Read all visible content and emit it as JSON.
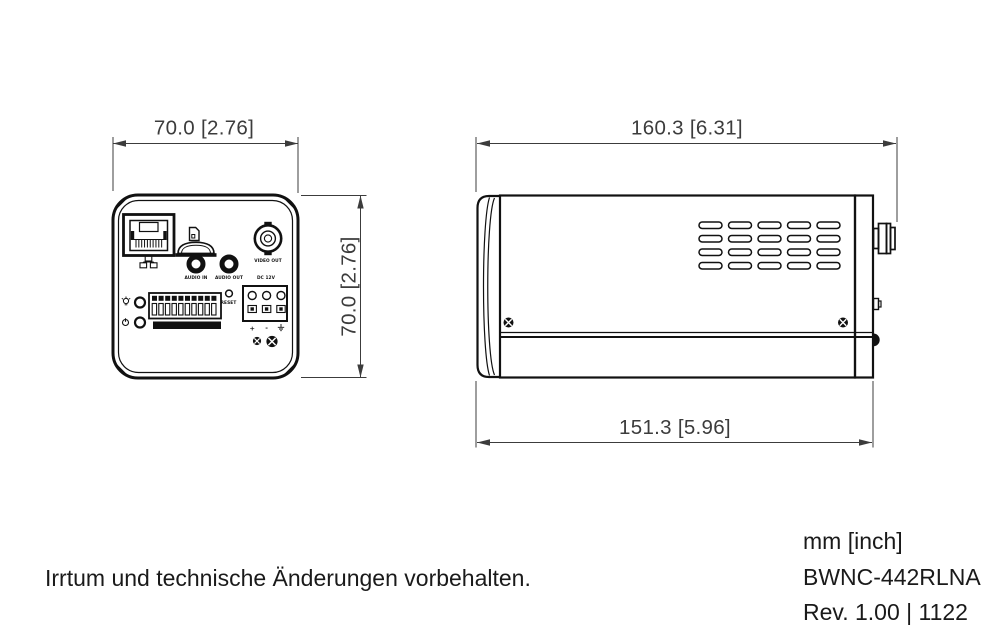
{
  "rear_view": {
    "dim_width": "70.0 [2.76]",
    "dim_height": "70.0 [2.76]",
    "labels": {
      "audio_in": "AUDIO IN",
      "audio_out": "AUDIO OUT",
      "dc_power": "DC 12V",
      "video_out": "VIDEO OUT",
      "reset": "RESET",
      "power_plus": "+",
      "power_minus": "-"
    }
  },
  "side_view": {
    "dim_length_overall": "160.3 [6.31]",
    "dim_length_body": "151.3 [5.96]"
  },
  "footer": {
    "disclaimer": "Irrtum und technische Änderungen vorbehalten.",
    "units_note": "mm [inch]",
    "model": "BWNC-442RLNA",
    "revision": "Rev. 1.00 | 1122"
  },
  "colors": {
    "line": "#111111",
    "dim_text": "#3c3c3c",
    "background": "#ffffff"
  }
}
